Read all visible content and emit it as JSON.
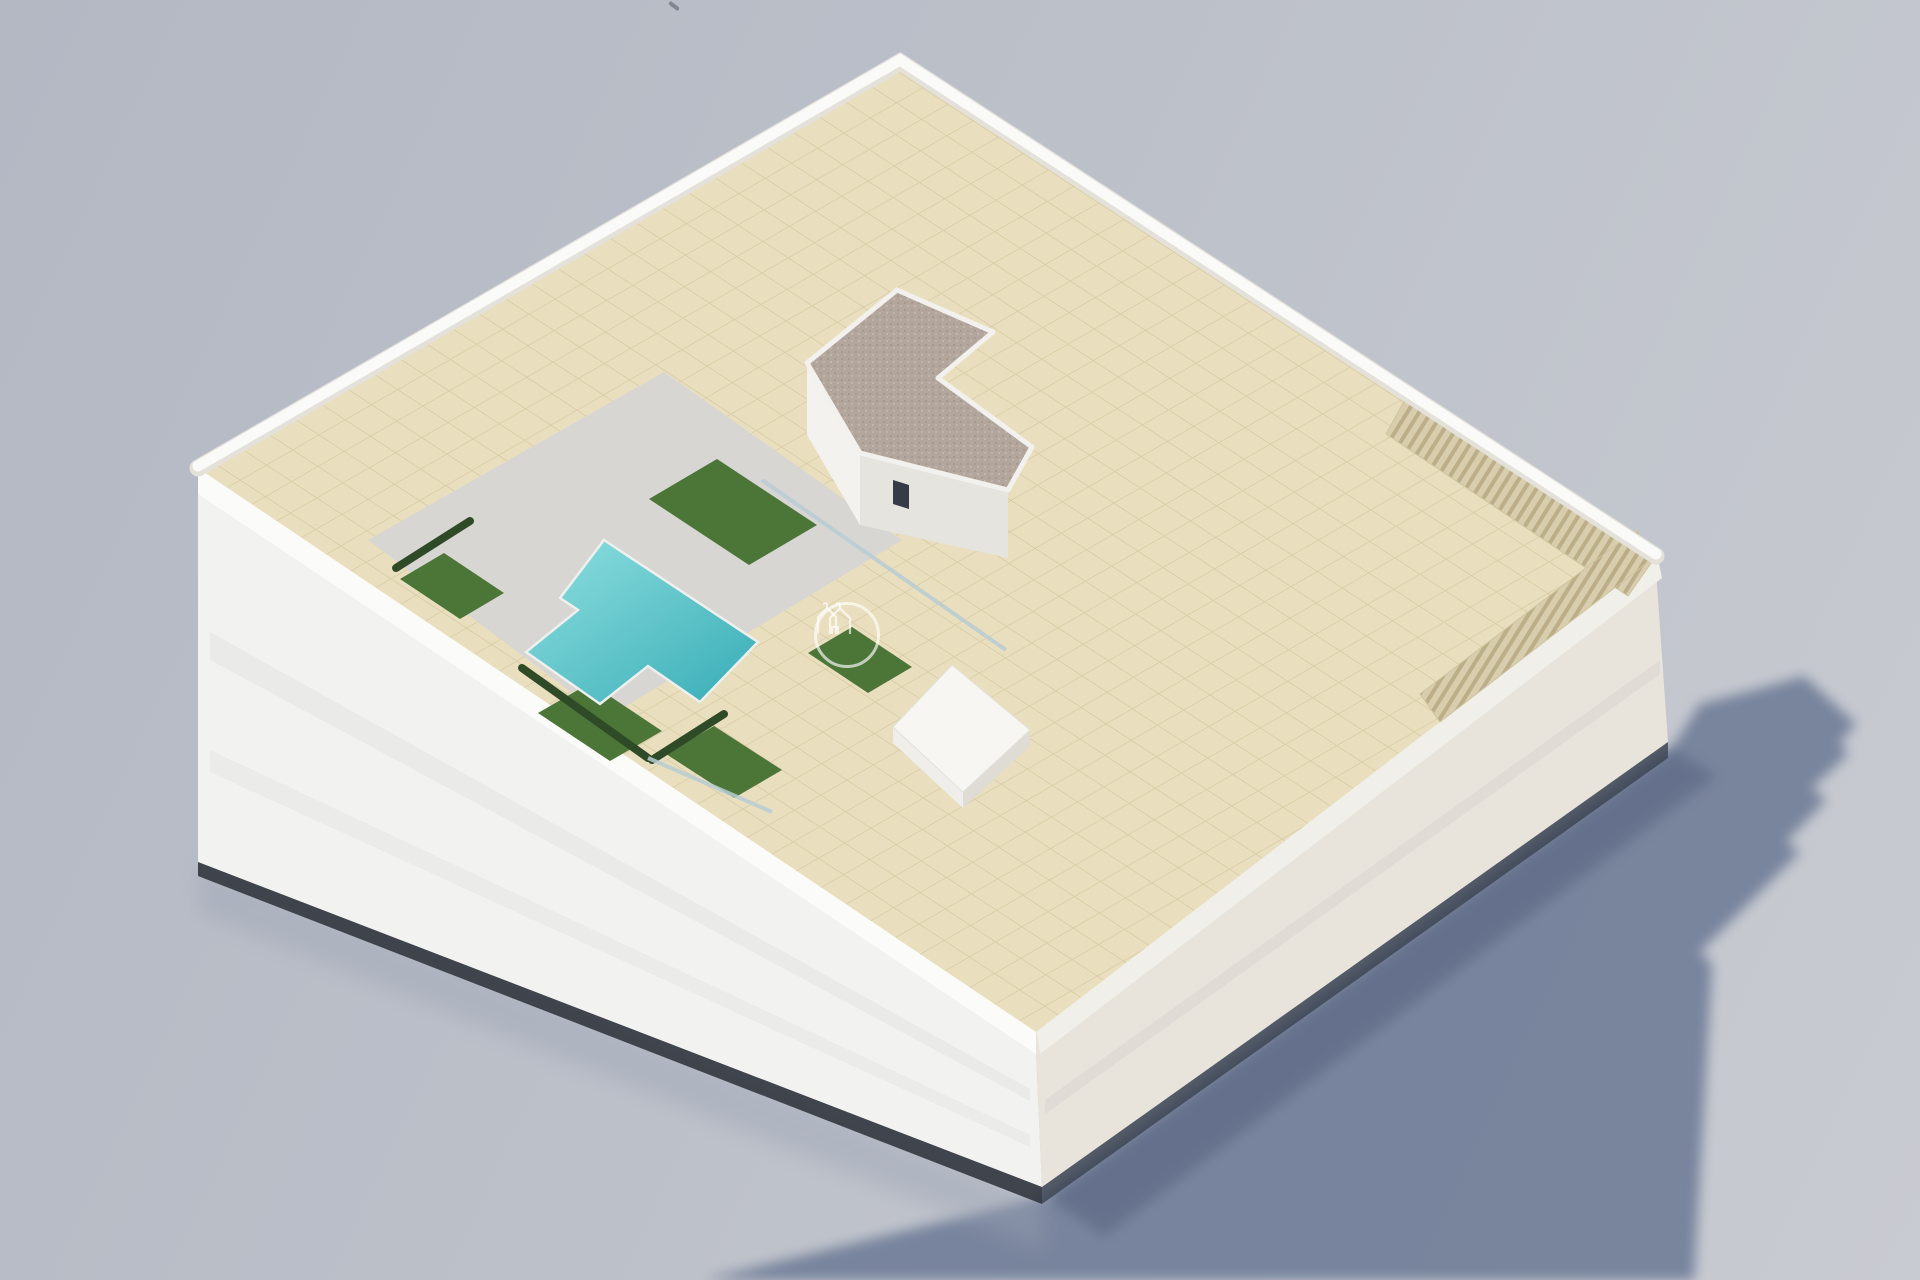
{
  "scene": {
    "alt": "Aerial 3D architectural rendering of a white apartment building with rooftop terraces, potted plants, parasols and a turquoise swimming pool, casting a long shadow on a plain grey ground"
  },
  "watermark": {
    "brand": "LARROSA&CO",
    "tagline": "PROPERTIES"
  },
  "colors": {
    "bg_1": "#b4b8c3",
    "bg_2": "#bcc0c9",
    "bg_3": "#c8cbd1",
    "shadow": "#74819b",
    "shadow_dark": "#57647f",
    "tile": "#e9dfbe",
    "tile_line": "#d7caa3",
    "wall": "#fafaf8",
    "facade_sw": "#f2f2f0",
    "facade_se": "#e8e4db",
    "window": "#353c45",
    "pool_light": "#8fe0e0",
    "pool_deep": "#37acb6",
    "deck": "#d7d6d3",
    "grass": "#4c7538",
    "gravel": "#b3a79d",
    "umbrella": "#ddd4c2",
    "wood": "#a8875a",
    "watermark": "rgba(255,255,255,0.66)",
    "watermark_soft": "rgba(255,255,255,0.55)"
  }
}
